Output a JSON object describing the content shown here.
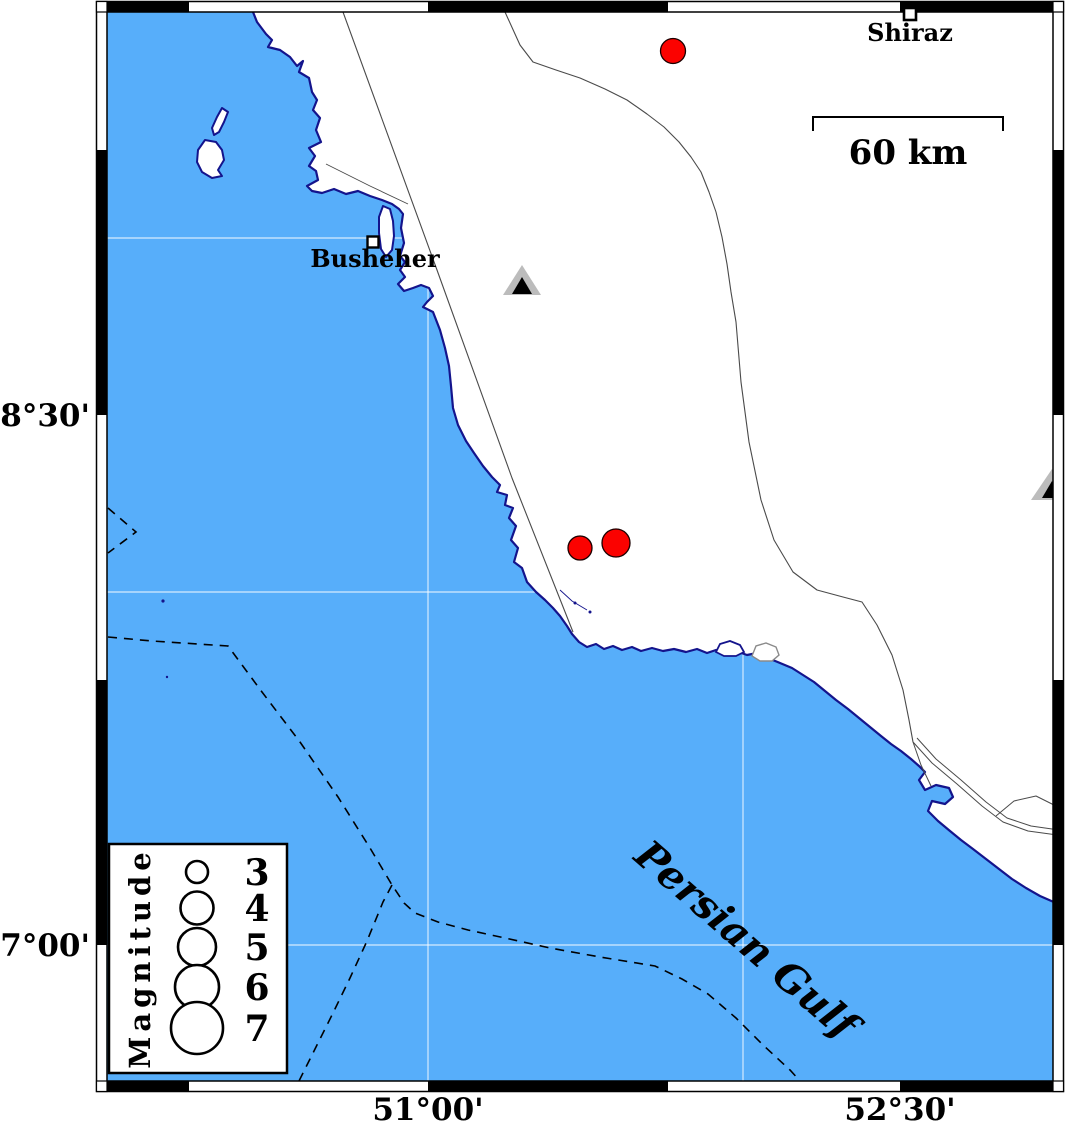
{
  "axis": {
    "lat_labels": [
      {
        "text": "28°30'"
      },
      {
        "text": "27°00'"
      }
    ],
    "lon_labels": [
      {
        "text": "51°00'"
      },
      {
        "text": "52°30'"
      }
    ]
  },
  "cities": [
    {
      "name": "Shiraz"
    },
    {
      "name": "Busheher"
    }
  ],
  "sea": {
    "name": "Persian Gulf"
  },
  "scale_bar": {
    "label": "60 km"
  },
  "legend": {
    "title": "Magnitude",
    "magnitudes": [
      {
        "label": "3"
      },
      {
        "label": "4"
      },
      {
        "label": "5"
      },
      {
        "label": "6"
      },
      {
        "label": "7"
      }
    ]
  },
  "symbols": {
    "earthquake_color": "#fb0200",
    "sea_color": "#57aefa",
    "coast_outline_color": "#14148c",
    "station_outer_color": "#bcbcbc",
    "station_inner_color": "#000000",
    "earthquake_count": 3,
    "station_count": 2
  }
}
